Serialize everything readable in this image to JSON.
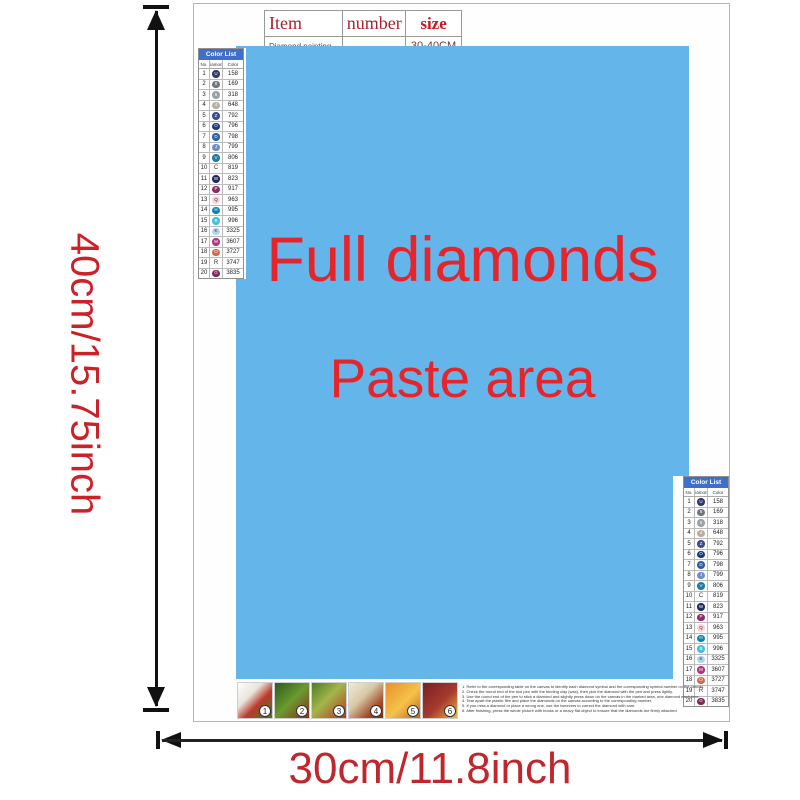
{
  "item_table": {
    "headers": [
      "Item",
      "number",
      "size"
    ],
    "row": {
      "item": "Diamond painting",
      "number": "",
      "size": "30-40CM"
    }
  },
  "paste_area": {
    "line1": "Full diamonds",
    "line2": "Paste area",
    "bg_color": "#64b5e9",
    "text_color": "#e6252b"
  },
  "dimensions": {
    "height_label": "40cm/15.75inch",
    "width_label": "30cm/11.8inch"
  },
  "color_list": {
    "title": "Color List",
    "columns": [
      "No.",
      "Diamond",
      "Color"
    ],
    "rows": [
      {
        "no": "1",
        "symbol": "U",
        "code": "158",
        "dot": "#2e3a6e",
        "sym_color": "#ffffff"
      },
      {
        "no": "2",
        "symbol": "8",
        "code": "169",
        "dot": "#6e7480",
        "sym_color": "#ffffff"
      },
      {
        "no": "3",
        "symbol": "6",
        "code": "318",
        "dot": "#9aa0a6",
        "sym_color": "#ffffff"
      },
      {
        "no": "4",
        "symbol": "4",
        "code": "648",
        "dot": "#b7b0a2",
        "sym_color": "#ffffff"
      },
      {
        "no": "5",
        "symbol": "Z",
        "code": "792",
        "dot": "#3c4c8e",
        "sym_color": "#ffffff"
      },
      {
        "no": "6",
        "symbol": "O",
        "code": "796",
        "dot": "#1c3a80",
        "sym_color": "#ffffff"
      },
      {
        "no": "7",
        "symbol": "D",
        "code": "798",
        "dot": "#2f5ea8",
        "sym_color": "#ffffff"
      },
      {
        "no": "8",
        "symbol": "J",
        "code": "799",
        "dot": "#6f8cc4",
        "sym_color": "#ffffff"
      },
      {
        "no": "9",
        "symbol": "V",
        "code": "806",
        "dot": "#1f7ca6",
        "sym_color": "#ffffff"
      },
      {
        "no": "10",
        "symbol": "C",
        "code": "819",
        "dot": "",
        "sym_color": "#333333"
      },
      {
        "no": "11",
        "symbol": "W",
        "code": "823",
        "dot": "#1f2a5e",
        "sym_color": "#ffffff"
      },
      {
        "no": "12",
        "symbol": "P",
        "code": "917",
        "dot": "#8e2a68",
        "sym_color": "#ffffff"
      },
      {
        "no": "13",
        "symbol": "Q",
        "code": "963",
        "dot": "#ffd2d8",
        "sym_color": "#333333"
      },
      {
        "no": "14",
        "symbol": "H",
        "code": "995",
        "dot": "#0e86b4",
        "sym_color": "#ffffff"
      },
      {
        "no": "15",
        "symbol": "B",
        "code": "996",
        "dot": "#45c0dc",
        "sym_color": "#ffffff"
      },
      {
        "no": "16",
        "symbol": "K",
        "code": "3325",
        "dot": "#b5d3ec",
        "sym_color": "#333333"
      },
      {
        "no": "17",
        "symbol": "M",
        "code": "3607",
        "dot": "#b03580",
        "sym_color": "#ffffff"
      },
      {
        "no": "18",
        "symbol": "O",
        "code": "3727",
        "dot": "#cf6a4e",
        "sym_color": "#ffffff"
      },
      {
        "no": "19",
        "symbol": "R",
        "code": "3747",
        "dot": "",
        "sym_color": "#333333"
      },
      {
        "no": "20",
        "symbol": "G",
        "code": "3835",
        "dot": "#7c2a5a",
        "sym_color": "#ffffff"
      }
    ]
  },
  "steps": [
    {
      "number": "1",
      "swatch": "linear-gradient(135deg,#ffffff 0%,#e8e4da 35%,#b93a2b 60%,#3f7a2c 100%)"
    },
    {
      "number": "2",
      "swatch": "linear-gradient(135deg,#2e5c1e 0%,#6a9a2f 50%,#8a2f1f 100%)"
    },
    {
      "number": "3",
      "swatch": "linear-gradient(135deg,#4f7a28 0%,#a3b64a 45%,#b33524 100%)"
    },
    {
      "number": "4",
      "swatch": "linear-gradient(135deg,#f2ead8 0%,#d8c9a8 40%,#a04a28 75%,#7a2d1a 100%)"
    },
    {
      "number": "5",
      "swatch": "linear-gradient(135deg,#e8912a 0%,#f5c24a 55%,#c2611d 100%)"
    },
    {
      "number": "6",
      "swatch": "linear-gradient(135deg,#7a1f24 0%,#a83a2e 55%,#e8b93a 100%)"
    }
  ],
  "instructions": [
    "1. Refer to the corresponding table on the canvas to identify each diamond symbol and the corresponding symbol number on the canvas.",
    "2. Check the round end of the tool pen with the binding clay (wax), then pick the diamond with the pen and press lightly.",
    "3. Use the round end of the pen to stick a diamond and slightly press down on the canvas in the marked area, one diamond each time.",
    "4. Tear apart the plastic film and place the diamonds on the canvas according to the corresponding number.",
    "5. If you miss a diamond or place a wrong one, use the tweezers to correct the diamond with care.",
    "6. After finishing, press the whole picture with books or a heavy flat object to ensure that the diamonds are firmly attached."
  ]
}
